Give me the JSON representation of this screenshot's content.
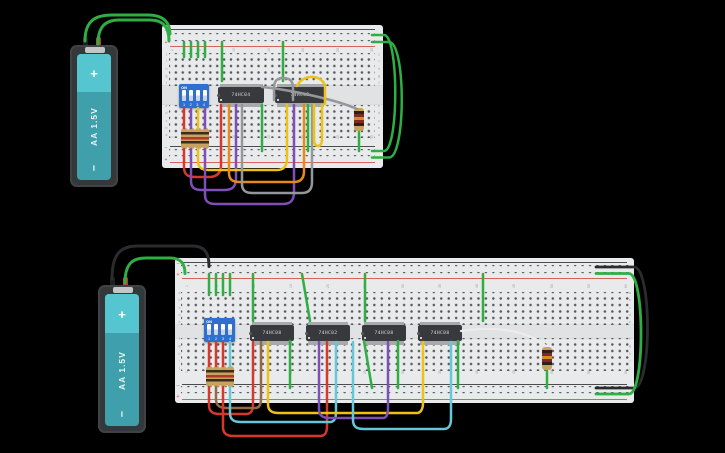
{
  "colors": {
    "background": "#000000",
    "wire_green": "#2fae43",
    "wire_red": "#d8382c",
    "wire_purple": "#7e4fb8",
    "wire_yellow": "#eec116",
    "wire_orange": "#e78a1d",
    "wire_gray": "#94989b",
    "wire_black": "#2a2c2e",
    "wire_brown": "#936a43",
    "wire_cyan": "#66c7d9",
    "wire_white": "#ececec",
    "board": "#e9eaeb",
    "rail_negative_line": "#4b4e50",
    "rail_positive_line": "#d4635c",
    "dip_blue": "#2e6fd0",
    "ic_body": "#37393c",
    "battery_teal": "#3f9fab",
    "battery_teal_light": "#55c6d0",
    "resistor_tan": "#c9a25f",
    "resistor_maroon": "#7e2a25"
  },
  "top_circuit": {
    "battery": {
      "plus": "+",
      "label": "AA 1.5V",
      "minus": "–"
    },
    "dip_switch": {
      "on_label": "ON",
      "switch_numbers": [
        "1",
        "2",
        "3",
        "4"
      ]
    },
    "ics": [
      {
        "label": "74HC04"
      },
      {
        "label": "74HC32"
      }
    ],
    "board": {
      "column_labels": [
        "1",
        "5",
        "10",
        "15",
        "20",
        "25",
        "30"
      ],
      "row_letters_upper": [
        "j",
        "i",
        "h",
        "g",
        "f"
      ],
      "row_letters_lower": [
        "e",
        "d",
        "c",
        "b",
        "a"
      ],
      "rail_minus": "–",
      "rail_plus": "+"
    }
  },
  "bottom_circuit": {
    "battery": {
      "plus": "+",
      "label": "AA 1.5V",
      "minus": "–"
    },
    "dip_switch": {
      "on_label": "ON",
      "switch_numbers": [
        "1",
        "2",
        "3",
        "4"
      ]
    },
    "ics": [
      {
        "label": "74HC08"
      },
      {
        "label": "74HC02"
      },
      {
        "label": "74HC08"
      },
      {
        "label": "74HC08"
      }
    ],
    "board": {
      "column_labels": [
        "1",
        "5",
        "10",
        "15",
        "20",
        "25",
        "30",
        "35",
        "40",
        "45",
        "50",
        "55",
        "60"
      ],
      "row_letters_upper": [
        "a",
        "b",
        "c",
        "d",
        "e"
      ],
      "row_letters_lower": [
        "f",
        "g",
        "h",
        "i",
        "j"
      ],
      "rail_minus": "–",
      "rail_plus": "+"
    }
  }
}
